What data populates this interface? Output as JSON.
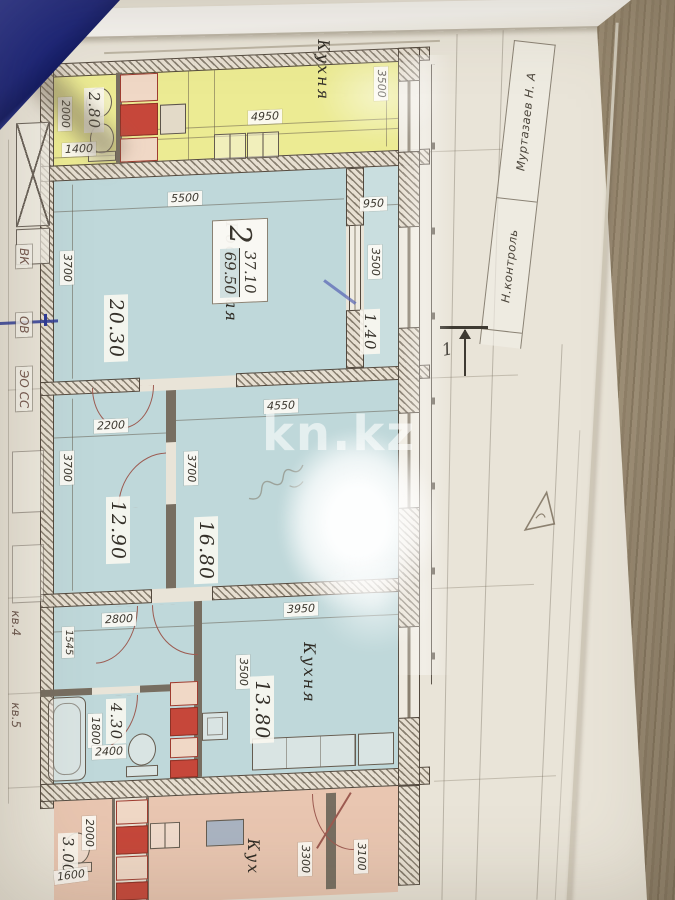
{
  "watermark": {
    "text": "kn.kz"
  },
  "titleblock": {
    "examiner_name": "Муртазаев Н. А",
    "examiner_role": "Н.контроль"
  },
  "section_mark": {
    "label": "1"
  },
  "apartment_stamp": {
    "rooms": "2",
    "living_area": "37.10",
    "total_area": "69.50"
  },
  "rooms": {
    "kitchen_top": {
      "name": "Кухня",
      "width": "4950",
      "depth": "3500"
    },
    "bath_top": {
      "area": "2.80",
      "depth": "2000",
      "width": "1400"
    },
    "living": {
      "name": "Гостиная",
      "area": "20.30",
      "width": "5500",
      "depth": "3700"
    },
    "balcony": {
      "area": "1.40",
      "width": "950",
      "depth": "3500"
    },
    "bedroom": {
      "area": "12.90",
      "width": "2200",
      "depth": "3700"
    },
    "bedroom2": {
      "area": "16.80",
      "width": "4550",
      "depth": "3700"
    },
    "hall": {
      "width": "2800",
      "depth": "1545"
    },
    "bathroom": {
      "area": "4.30",
      "depth": "1800",
      "width": "2400"
    },
    "kitchen": {
      "name": "Кухня",
      "area": "13.80",
      "width": "3950",
      "depth": "3500"
    },
    "lower_room": {
      "area": "3.00",
      "depth": "2000",
      "width": "1600"
    },
    "lower_kitchen": {
      "name": "Кух",
      "depth": "3300"
    },
    "lower_room2": {
      "depth": "3100"
    }
  },
  "shaft_labels": {
    "vk": "ВК",
    "ov": "ОВ",
    "eo": "ЭО СС",
    "kv4": "кв.4",
    "kv5": "кв.5"
  }
}
